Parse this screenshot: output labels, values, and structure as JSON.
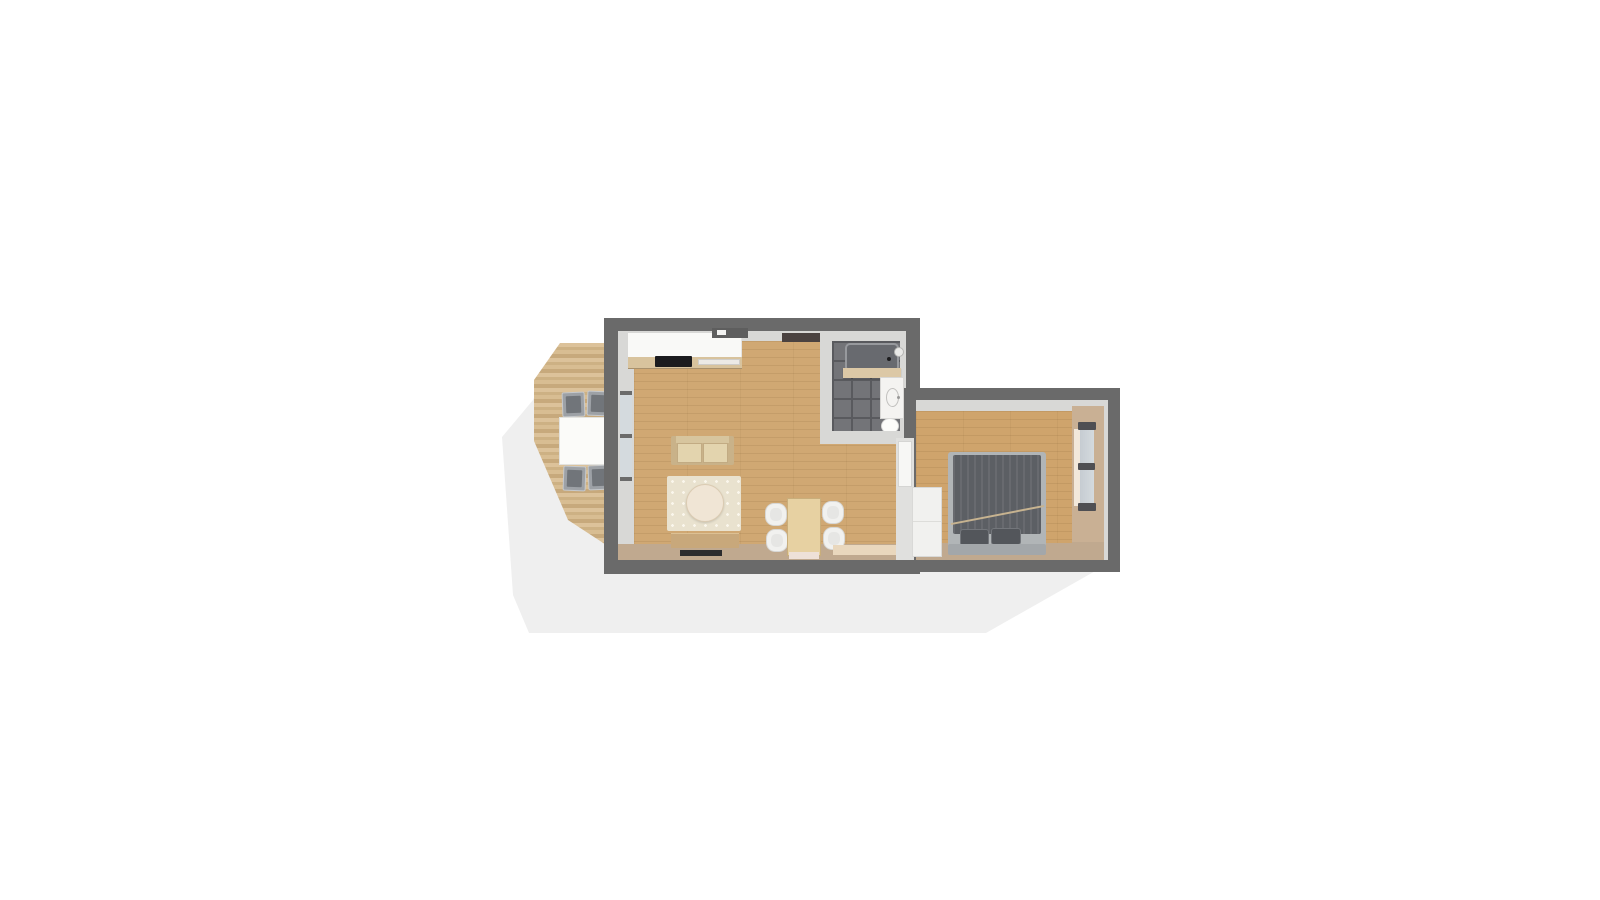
{
  "scene": {
    "type": "3d-floorplan-top-view",
    "description": "Top-down 3D render of a small one-bedroom apartment with an outdoor wooden deck, centered on a white page with a soft gray ground shadow",
    "visible_text": "none"
  },
  "palette": {
    "shadow": "#efefef",
    "wall": "#6a6a6a",
    "wall_inner": "#d8d8d6",
    "face_beige": "#c0a98f",
    "floor_wood": "#d0a873",
    "bedroom_floor": "#cfa46c",
    "deck_wood_light": "#dcc29a",
    "deck_wood_dark": "#c7a97c",
    "bath_tile": "#737478",
    "bath_grout": "#595a5e",
    "rug": "#e9e2cf",
    "sofa": "#c9b289",
    "counter_white": "#f9f9f7",
    "wood_furniture": "#c8a87b",
    "chair_white": "#f1f1ef",
    "outdoor_chair": "#9da1a6",
    "bed_duvet": "#5c5f64",
    "bed_frame": "#b1b5b7",
    "door_dark": "#4a4240",
    "window_glass": "#d4dade"
  },
  "rooms": [
    {
      "name": "deck",
      "floor": "wood decking planks",
      "furniture": [
        "outdoor dining table",
        "4 gray outdoor chairs"
      ]
    },
    {
      "name": "living-room-kitchen",
      "floor": "light oak planks",
      "furniture": [
        "kitchen counter with cooktop and sink",
        "beige sofa",
        "patterned area rug",
        "round coffee table",
        "tv stand",
        "dining table",
        "4 white dining chairs",
        "doormat"
      ]
    },
    {
      "name": "bathroom",
      "floor": "dark gray tile",
      "furniture": [
        "shower with drain and shower head",
        "shelf bench",
        "vanity with basin",
        "toilet",
        "dark open door"
      ]
    },
    {
      "name": "bedroom",
      "floor": "light oak planks",
      "furniture": [
        "double bed with gray duvet and two pillows",
        "white wardrobe",
        "right-wall window",
        "white door"
      ]
    }
  ]
}
